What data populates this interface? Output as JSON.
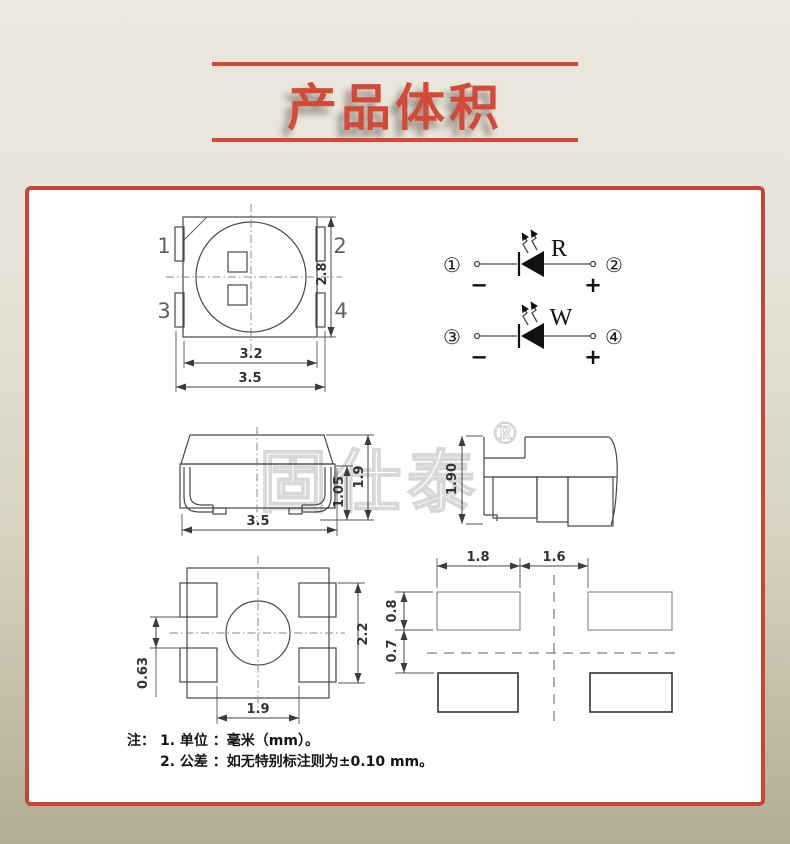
{
  "header": {
    "title": "产品体积"
  },
  "watermark": {
    "brand": "固仕泰",
    "registered": "®"
  },
  "top_view": {
    "pins": {
      "p1": "1",
      "p2": "2",
      "p3": "3",
      "p4": "4"
    },
    "dims": {
      "inner_width": "3.2",
      "outer_width": "3.5",
      "body_height": "2.8"
    }
  },
  "circuit": {
    "rows": [
      {
        "pin_left": "①",
        "pin_right": "②",
        "label": "R",
        "neg": "−",
        "pos": "+"
      },
      {
        "pin_left": "③",
        "pin_right": "④",
        "label": "W",
        "neg": "−",
        "pos": "+"
      }
    ]
  },
  "front_view": {
    "dims": {
      "width": "3.5",
      "body_height": "1.05",
      "total_height": "1.9"
    }
  },
  "side_view": {
    "dims": {
      "total_height": "1.90"
    }
  },
  "bottom_view": {
    "dims": {
      "pad_gap": "0.63",
      "pad_span": "2.2",
      "inner_width": "1.9"
    }
  },
  "pad_layout": {
    "dims": {
      "pad_width": "1.8",
      "center_gap": "1.6",
      "pad_height": "0.8",
      "row_offset": "0.7"
    }
  },
  "notes": {
    "prefix": "注：",
    "lines": [
      "1. 单位 ：毫米（mm）。",
      "2. 公差 ：如无特别标注则为±0.10 mm。"
    ]
  },
  "colors": {
    "accent_red": "#d0493b",
    "border_red": "#c7463a",
    "line_dark": "#474747",
    "watermark_gray": "#d8d8d8",
    "panel_bg": "#ffffff",
    "page_bg_top": "#ebe8de",
    "page_bg_bottom": "#b3ac92"
  }
}
